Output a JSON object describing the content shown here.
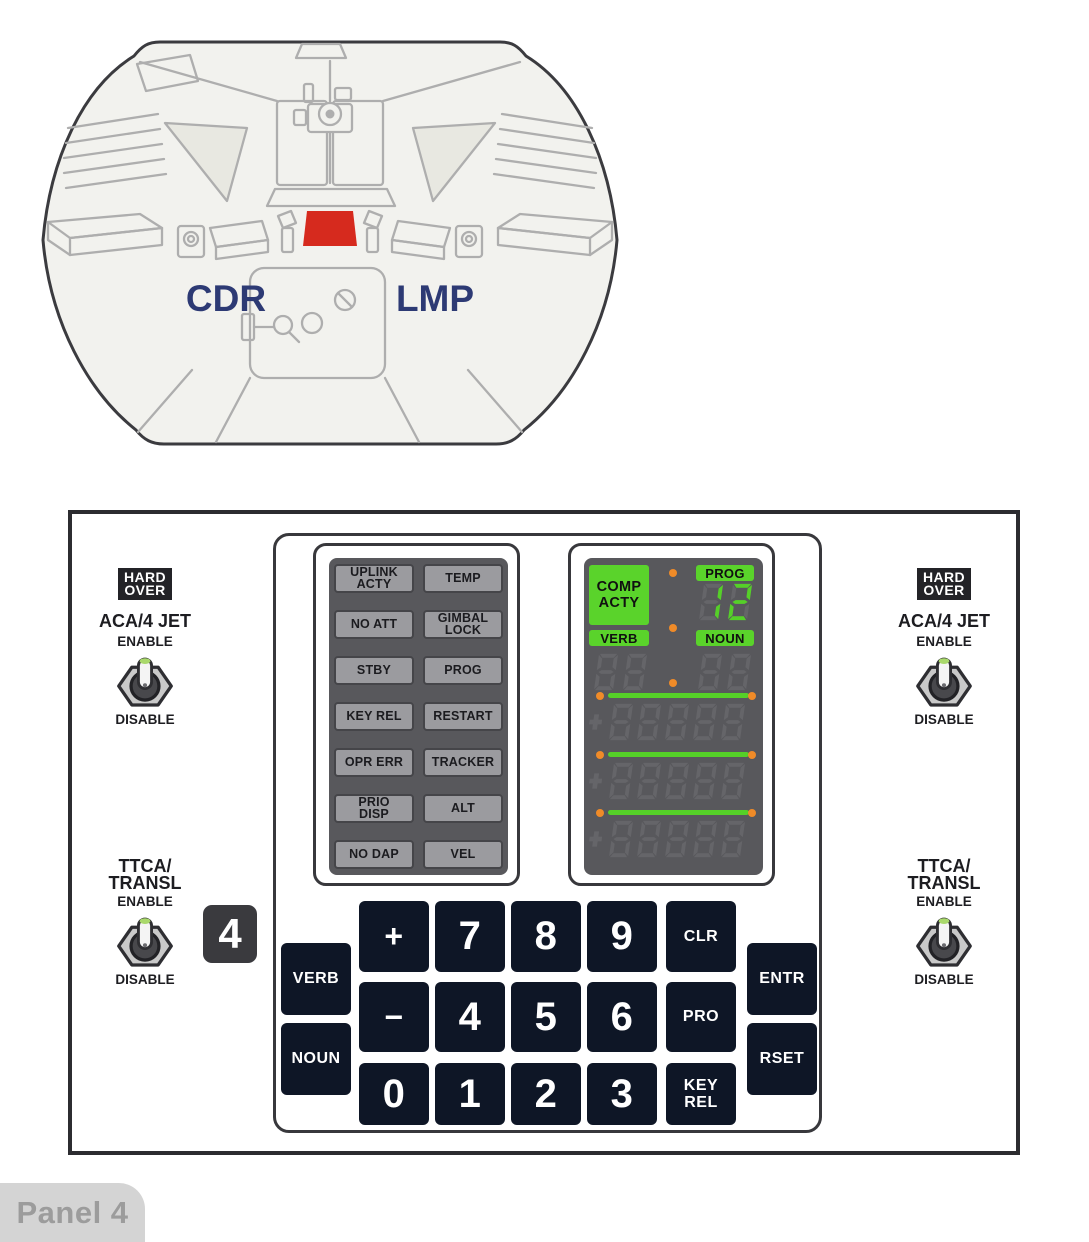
{
  "colors": {
    "highlight_red": "#d62a1e",
    "display_green": "#55d028",
    "indicator_orange": "#f08b28",
    "label_navy": "#2d3a74",
    "key_navy": "#0e1626",
    "panel_gray": "#58585c",
    "light_button_gray": "#9b9b9f"
  },
  "cockpit": {
    "cdr_label": "CDR",
    "lmp_label": "LMP"
  },
  "switches": {
    "hard_over_lines": [
      "HARD",
      "OVER"
    ],
    "aca_label": "ACA/4 JET",
    "ttca_lines": [
      "TTCA/",
      "TRANSL"
    ],
    "enable_label": "ENABLE",
    "disable_label": "DISABLE"
  },
  "panel_number_badge": "4",
  "warning_lights": {
    "items": [
      {
        "name": "uplink-acty",
        "lines": [
          "UPLINK",
          "ACTY"
        ]
      },
      {
        "name": "temp",
        "lines": [
          "TEMP"
        ]
      },
      {
        "name": "no-att",
        "lines": [
          "NO ATT"
        ]
      },
      {
        "name": "gimbal-lock",
        "lines": [
          "GIMBAL",
          "LOCK"
        ]
      },
      {
        "name": "stby",
        "lines": [
          "STBY"
        ]
      },
      {
        "name": "prog",
        "lines": [
          "PROG"
        ]
      },
      {
        "name": "key-rel",
        "lines": [
          "KEY REL"
        ]
      },
      {
        "name": "restart",
        "lines": [
          "RESTART"
        ]
      },
      {
        "name": "opr-err",
        "lines": [
          "OPR ERR"
        ]
      },
      {
        "name": "tracker",
        "lines": [
          "TRACKER"
        ]
      },
      {
        "name": "prio-disp",
        "lines": [
          "PRIO",
          "DISP"
        ]
      },
      {
        "name": "alt",
        "lines": [
          "ALT"
        ]
      },
      {
        "name": "no-dap",
        "lines": [
          "NO DAP"
        ]
      },
      {
        "name": "vel",
        "lines": [
          "VEL"
        ]
      }
    ]
  },
  "display": {
    "comp_acty_lines": [
      "COMP",
      "ACTY"
    ],
    "prog_label": "PROG",
    "prog_value": "12",
    "verb_label": "VERB",
    "verb_value": "",
    "noun_label": "NOUN",
    "noun_value": "",
    "registers": [
      {
        "sign": "+",
        "value": ""
      },
      {
        "sign": "+",
        "value": ""
      },
      {
        "sign": "+",
        "value": ""
      }
    ]
  },
  "keypad": {
    "verb": "VERB",
    "noun": "NOUN",
    "plus": "+",
    "minus": "−",
    "d0": "0",
    "d1": "1",
    "d2": "2",
    "d3": "3",
    "d4": "4",
    "d5": "5",
    "d6": "6",
    "d7": "7",
    "d8": "8",
    "d9": "9",
    "clr": "CLR",
    "pro": "PRO",
    "key_rel_lines": [
      "KEY",
      "REL"
    ],
    "entr": "ENTR",
    "rset": "RSET"
  },
  "footer": {
    "label": "Panel 4"
  }
}
